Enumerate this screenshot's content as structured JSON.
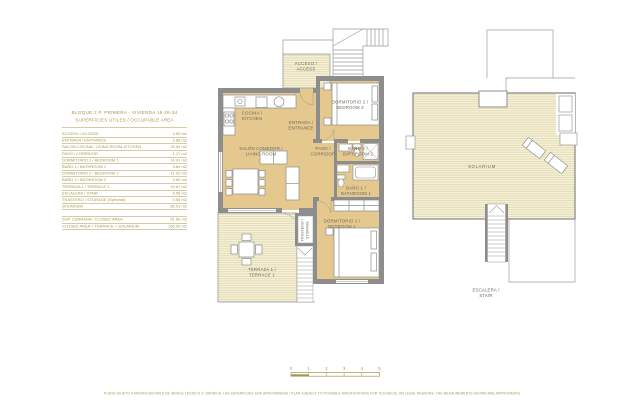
{
  "page": {
    "title_line1": "BLOQUE 2  P. PRIMERA - VIVIENDA 18-26-34",
    "title_line2": "SUPERFICIES ÚTILES / OCCUPABLE  AREA",
    "disclaimer": "PLANO SUJETO A MODIFICACIONES DE ÍNDOLE TÉCNICO O JURÍDICA. LAS SUPERFICIES SON APROXIMADAS / PLAN SUBJECT TO POSSIBLE MODIFICATIONS FOR TECHNICAL OR LEGAL REASONS. THE MEASUREMENTS SHOWN ARE APPROXIMATE"
  },
  "area_table": {
    "rows": [
      {
        "label": "ACCESO / ACCESS",
        "value": "4.50 m2"
      },
      {
        "label": "ENTRADA / ENTRANCE",
        "value": "2.88 m2"
      },
      {
        "label": "SALON-COCINA / LIVING ROOM-KITCHEN",
        "value": "29.54 m2"
      },
      {
        "label": "PASO / CORRIDOR",
        "value": "1.17 m2"
      },
      {
        "label": "DORMITORIO 1 / BEDROOM 1",
        "value": "14.91 m2"
      },
      {
        "label": "BAÑO 1 / BATHROOM 1",
        "value": "3.84 m2"
      },
      {
        "label": "DORMITORIO 2 / BEDROOM 2",
        "value": "11.02 m2"
      },
      {
        "label": "BAÑO 2 / BATHROOM 2",
        "value": "3.60 m2"
      },
      {
        "label": "TERRAZA 1 / TERRACE 1",
        "value": "19.67 m2"
      },
      {
        "label": "ESCALERA / STAIR",
        "value": "3.58 m2"
      },
      {
        "label": "TRASTERO / STORAGE (Optional)",
        "value": "0.56 m2"
      },
      {
        "label": "SOLARIUM",
        "value": "85.03 m2"
      }
    ],
    "summary": [
      {
        "label": "SUP. CERRADA / CLOSED AREA",
        "value": "81.86 m2"
      },
      {
        "label": "CLOSED AREA + TERRACE + SOLARIUM",
        "value": "156.50 m2"
      }
    ]
  },
  "plan": {
    "labels": {
      "acceso": [
        "ACCESO /",
        "ACCESS"
      ],
      "cocina": [
        "COCINA /",
        "KITCHEN"
      ],
      "entrada": [
        "ENTRADA /",
        "ENTRANCE"
      ],
      "salon": [
        "SALÓN COMEDOR /",
        "LIVING ROOM"
      ],
      "paso": [
        "PASO /",
        "CORRIDOR"
      ],
      "dormitorio2": [
        "DORMITORIO 2 /",
        "BEDROOM 2"
      ],
      "bano2": [
        "BAÑO 2 /",
        "BATHROOM 2"
      ],
      "bano1": [
        "BAÑO 1 /",
        "BATHROOM 1"
      ],
      "dormitorio1": [
        "DORMITORIO 1 /",
        "BEDROOM 1"
      ],
      "terraza": [
        "TERRAZA 1 /",
        "TERRACE 1"
      ],
      "trastero": [
        "TRASTERO /",
        "STORAGE"
      ],
      "solarium": "SOLARIUM",
      "escalera": [
        "ESCALERA /",
        "STAIR"
      ]
    }
  },
  "scale_bar": {
    "ticks": [
      "0",
      "1",
      "2",
      "3",
      "4",
      "5"
    ]
  },
  "colors": {
    "accent_gold": "#a3984f",
    "wall_gray": "#8d8d8d",
    "floor_tan": "#e5c88e",
    "deck_cream": "#f6f1d8",
    "plan_text": "#6f675c"
  }
}
